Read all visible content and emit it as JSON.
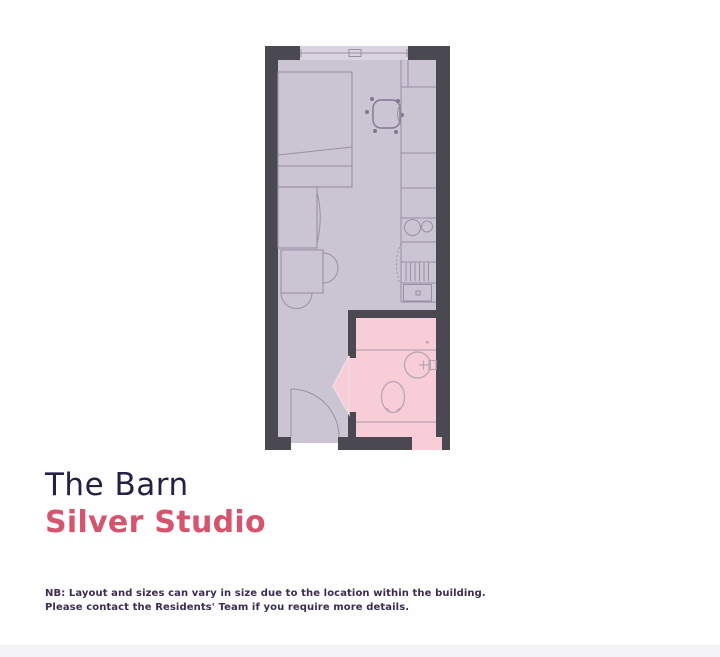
{
  "heading": {
    "building": "The Barn",
    "unit": "Silver Studio"
  },
  "disclaimer": {
    "line1": "NB: Layout and sizes can vary in size due to the location within the building.",
    "line2": "Please contact the Residents' Team if you require more details."
  },
  "plan": {
    "type": "studio-floorplan",
    "rooms": [
      "studio-room",
      "bathroom"
    ],
    "features": [
      "window",
      "bed",
      "wardrobe",
      "desk",
      "desk-chair",
      "stool",
      "dining-table",
      "table-chair",
      "kitchen-counter",
      "hob",
      "drying-rack",
      "kitchen-unit",
      "cupboard-swing",
      "entry-door",
      "bathroom-door",
      "sink",
      "toilet",
      "shower-area"
    ]
  },
  "colors": {
    "wall": "#4a4850",
    "floor": "#cbc4d3",
    "window": "#dad4e1",
    "line": "#9a90a5",
    "line_dark": "#827791",
    "bath_floor": "#f8cdd7",
    "bath_line": "#b4a4b2",
    "wedge_stroke": "#ecdce3",
    "title_ink": "#272045",
    "accent": "#d4556d",
    "note_ink": "#3b2c52",
    "page_bg": "#fefefe",
    "footer_band": "#f3f2f4"
  }
}
